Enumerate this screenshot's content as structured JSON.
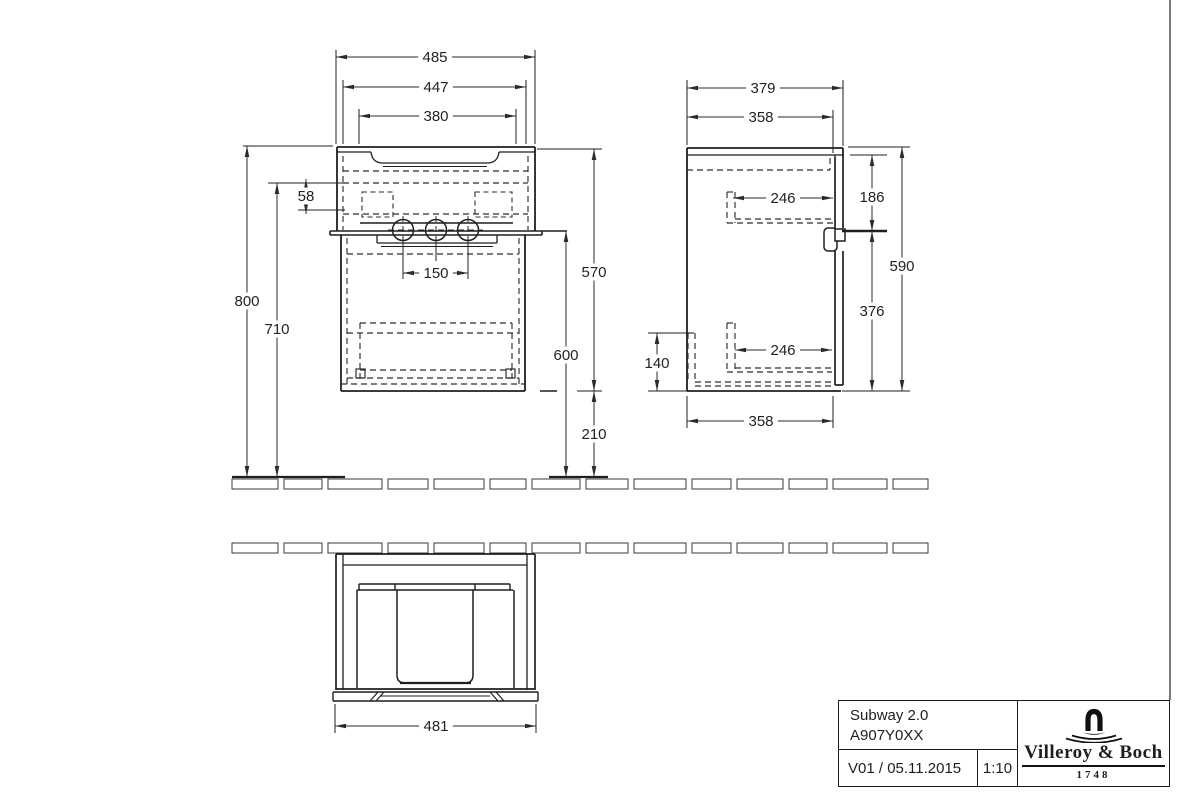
{
  "drawing": {
    "front_view": {
      "dims": {
        "basin_width": "485",
        "cabinet_width": "447",
        "inner_width": "380",
        "hole_offset": "58",
        "tap_spacing": "150",
        "mount_height": "800",
        "underside_height": "710",
        "unit_height": "570",
        "basin_height": "600",
        "clearance_height": "210"
      }
    },
    "side_view": {
      "dims": {
        "total_depth": "379",
        "top_depth": "358",
        "upper_bracket_depth": "246",
        "lower_bracket_depth": "246",
        "upper_section_height": "186",
        "body_height": "590",
        "lower_section_height": "376",
        "bottom_bracket_height": "140",
        "bottom_depth": "358"
      }
    },
    "plan_view": {
      "dims": {
        "body_width": "481"
      }
    },
    "title_block": {
      "product_line": "Subway 2.0",
      "article_number": "A907Y0XX",
      "version_date": "V01 / 05.11.2015",
      "scale": "1:10",
      "brand": "Villeroy & Boch",
      "brand_since": "1748"
    },
    "colors": {
      "line": "#1f1f1f",
      "dim": "#2b2b2b",
      "background": "#ffffff"
    }
  }
}
